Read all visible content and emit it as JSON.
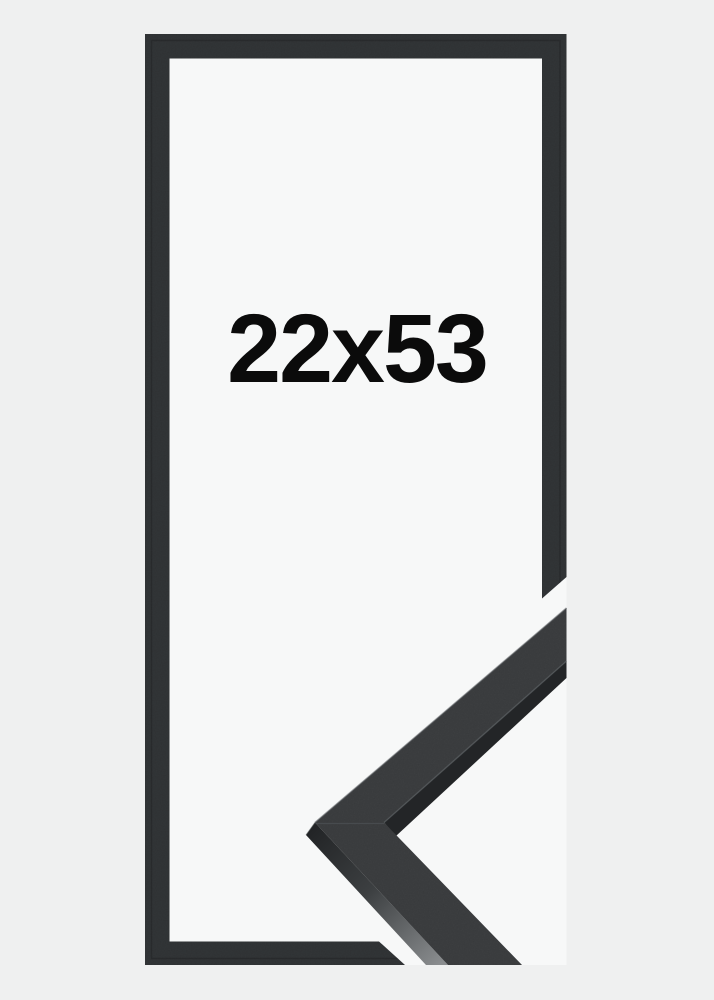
{
  "product": {
    "size_label": "22x53"
  },
  "colors": {
    "background": "#eff0f0",
    "inner_background": "#f7f8f8",
    "frame_outline": "#2e3133",
    "sample_front": "#37393b",
    "sample_lip": "#232527",
    "sample_side_top": "#222426",
    "sample_side_mid": "#3c3f41",
    "sample_side_bottom": "#8a8d8f",
    "edge_highlight": "#575b5e",
    "seam": "#4b4f52",
    "text": "#0b0b0b"
  }
}
